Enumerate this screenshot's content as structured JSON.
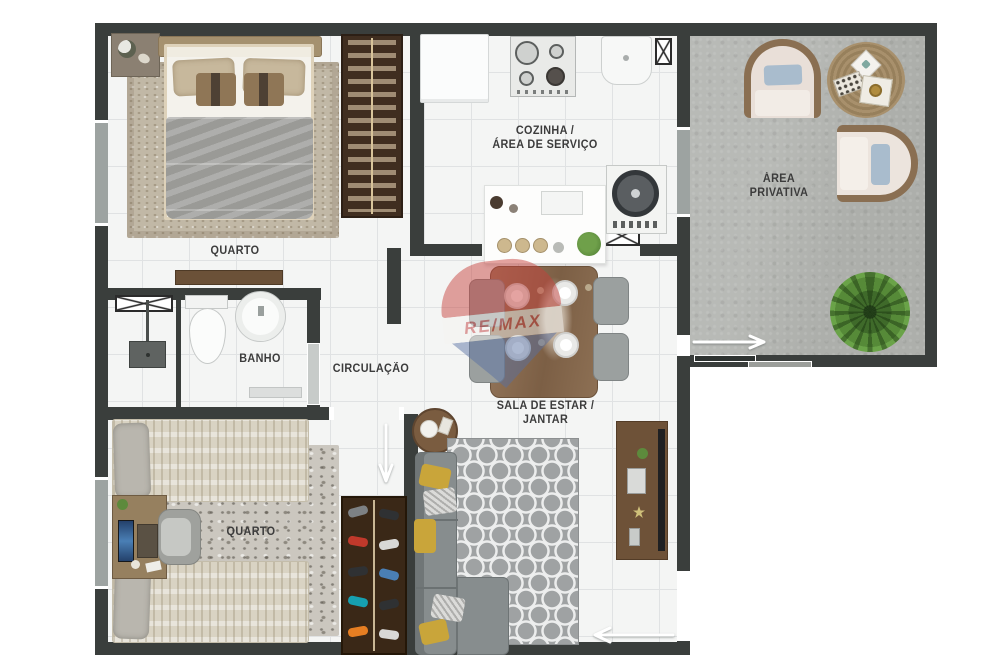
{
  "floorplan": {
    "watermark": {
      "brand": "RE/MAX"
    },
    "labels": {
      "bedroom1": "QUARTO",
      "bathroom": "BANHO",
      "circulation": "CIRCULAÇÃO",
      "kitchen_line1": "COZINHA /",
      "kitchen_line2": "ÁREA DE SERVIÇO",
      "living_line1": "SALA DE ESTAR /",
      "living_line2": "JANTAR",
      "bedroom2": "QUARTO",
      "private_line1": "ÁREA",
      "private_line2": "PRIVATIVA"
    },
    "icons": {
      "vent_box": "rectangle crossed with X (duct/shaft symbol)",
      "door_arrow": "white arrow showing door opening direction",
      "sliding_door": "offset parallel bars on wall"
    },
    "colors": {
      "wall": "#3a3e3c",
      "floor_tile": "#f4f5f4",
      "tile_grout": "#e0e2e3",
      "concrete_floor": "#b4b6b2",
      "label_text": "#3c3c3c",
      "remax_red": "#c7403c",
      "remax_blue": "#5870a3",
      "wood": "#7c5f45",
      "wardrobe_wood": "#3a2817",
      "sofa_gray": "#878d8e",
      "pillow_yellow": "#c9a53a",
      "plant_green": "#4e7a33",
      "duvet_gray": "#a3a3a0",
      "rug_beige": "#c1b8a6"
    }
  }
}
